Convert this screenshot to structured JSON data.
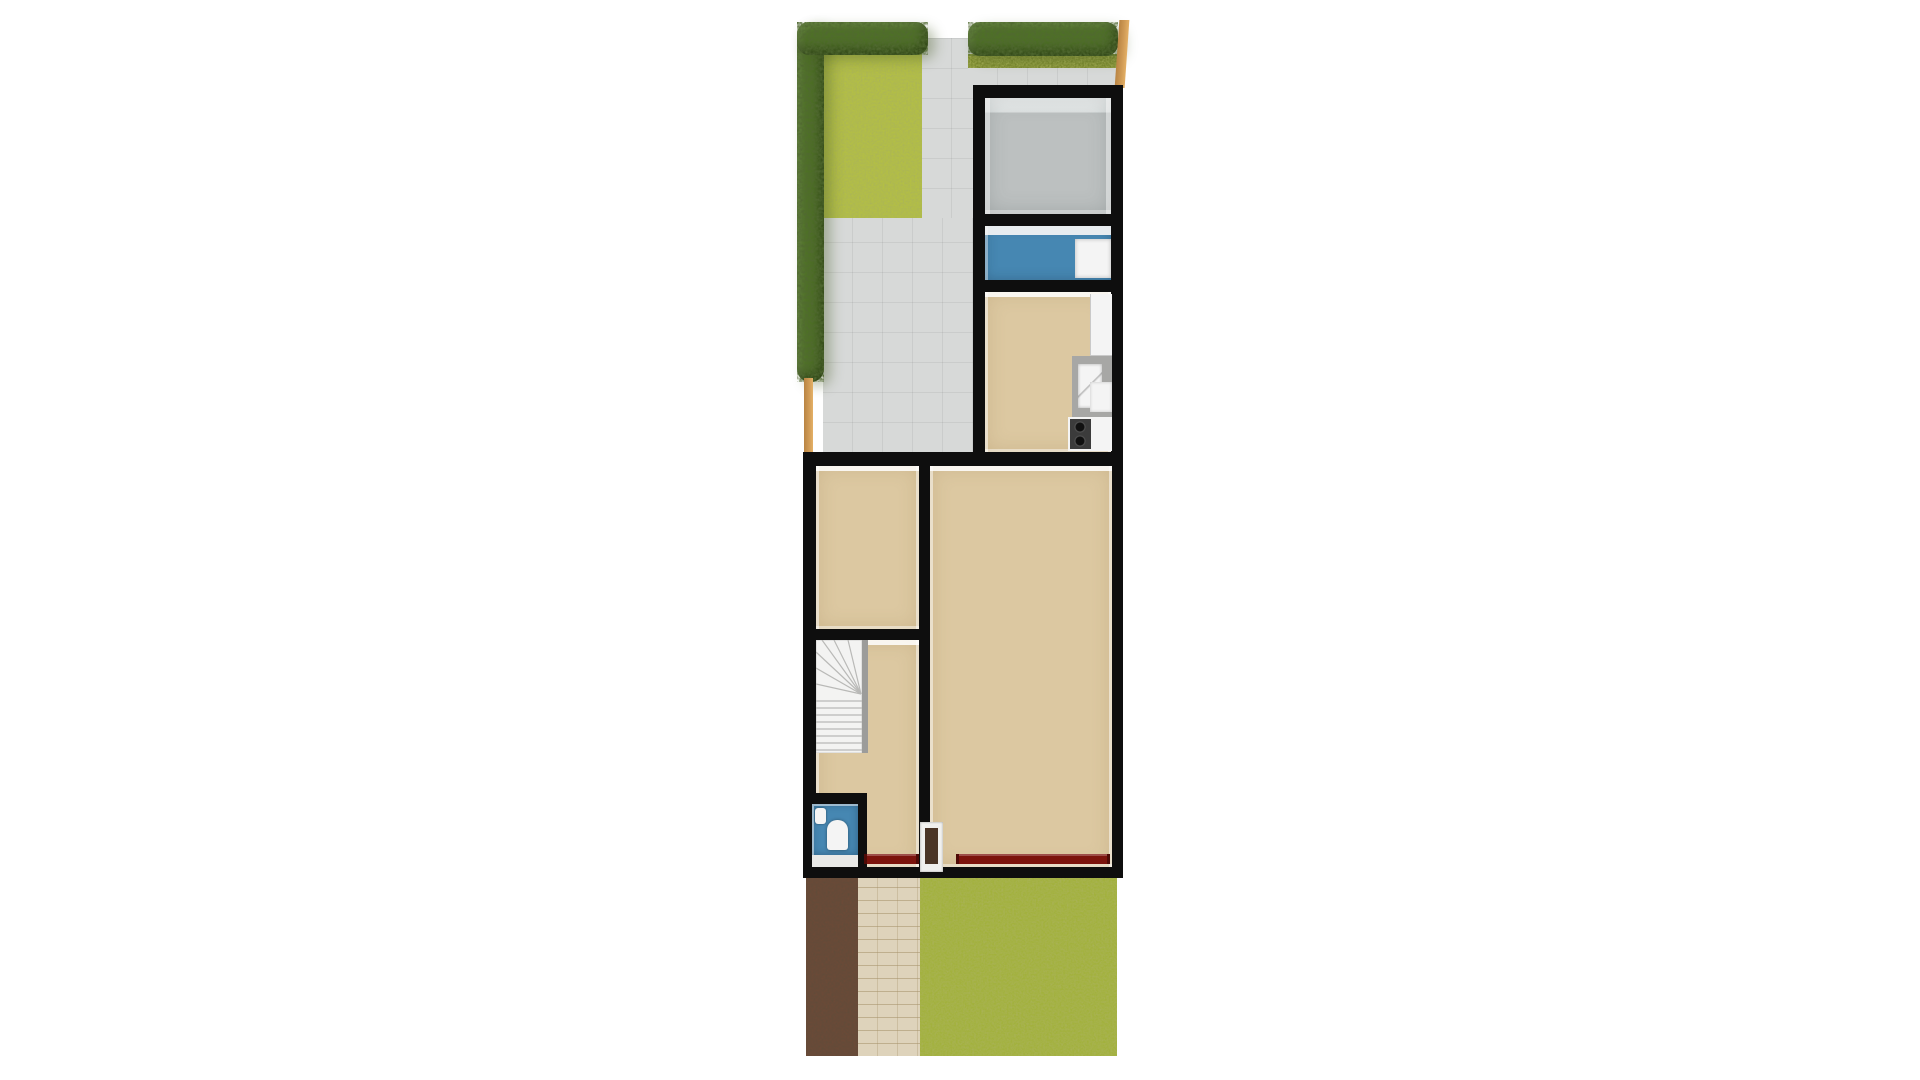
{
  "scene": {
    "kind": "3d-floorplan-top-view",
    "background": "#ffffff"
  },
  "colors": {
    "wall": "#0e0e0e",
    "paving": "#d7d9d8",
    "grass_back": "#b3bf44",
    "grass_front": "#a2b13c",
    "grass_edge": "#78872d",
    "hedge": "#4e7026",
    "fence": "#cf9a55",
    "soil": "#6b4a37",
    "brick": "#ded3bb",
    "floor_beige": "#dcc8a1",
    "floor_gray": "#bcc0c0",
    "floor_blue": "#4687b2",
    "counter": "#a7a7a5",
    "fixture_white": "#f4f4f4",
    "radiator": "#7c130c",
    "door": "#4a3526",
    "rail": "#9c9c9a"
  },
  "floorplan": {
    "outbuilding": {
      "rooms": [
        {
          "name": "storage room",
          "floor": "gray",
          "fixtures": []
        },
        {
          "name": "utility room",
          "floor": "blue",
          "fixtures": [
            "wall shelf",
            "white appliance"
          ]
        },
        {
          "name": "kitchen",
          "floor": "beige",
          "fixtures": [
            "tall cabinet",
            "counter with sink",
            "low cabinet",
            "stove with burners"
          ]
        }
      ]
    },
    "main_house": {
      "rooms": [
        {
          "name": "front room",
          "floor": "beige",
          "fixtures": []
        },
        {
          "name": "living room",
          "floor": "beige",
          "fixtures": [
            "radiator"
          ]
        },
        {
          "name": "hallway",
          "floor": "beige",
          "fixtures": [
            "winder staircase",
            "radiator",
            "front door"
          ]
        },
        {
          "name": "toilet",
          "floor": "blue",
          "fixtures": [
            "toilet",
            "washbasin"
          ]
        }
      ]
    },
    "outdoor": {
      "features": [
        "L-shaped hedge",
        "back lawn",
        "paved patio with path",
        "right hedge row",
        "wooden fence segments",
        "soil bed",
        "brick garden path",
        "front lawn"
      ]
    }
  }
}
